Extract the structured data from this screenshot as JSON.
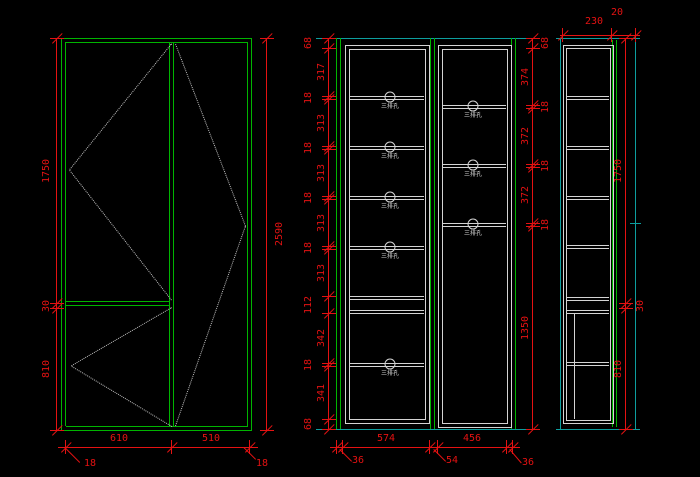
{
  "drawing": {
    "fitting_label": "三排孔",
    "views": {
      "front_elevation": {
        "dims_left": [
          "1750",
          "30",
          "810"
        ],
        "dims_right": [
          "2590"
        ],
        "dims_bottom": [
          "610",
          "510"
        ],
        "dims_thickness": [
          "18",
          "18"
        ]
      },
      "carcass_elevation": {
        "dims_left": [
          "68",
          "317",
          "18",
          "313",
          "18",
          "313",
          "18",
          "313",
          "18",
          "313",
          "112",
          "342",
          "18",
          "341",
          "68"
        ],
        "dims_right": [
          "68",
          "374",
          "18",
          "372",
          "18",
          "372",
          "18",
          "1350"
        ],
        "dims_bottom": [
          "574",
          "456"
        ],
        "dims_bottom2": [
          "36",
          "54",
          "36"
        ]
      },
      "side_section": {
        "dims_top": [
          "230",
          "20"
        ],
        "dims_right": [
          "1750",
          "30",
          "810"
        ]
      }
    },
    "colors": {
      "background": "#000000",
      "outline_green": "#00b400",
      "panel_gray": "#d4d4d4",
      "dimension_red": "#e51212",
      "teal": "#0d9e9e",
      "dashed_gray": "#c0c0c0"
    }
  }
}
